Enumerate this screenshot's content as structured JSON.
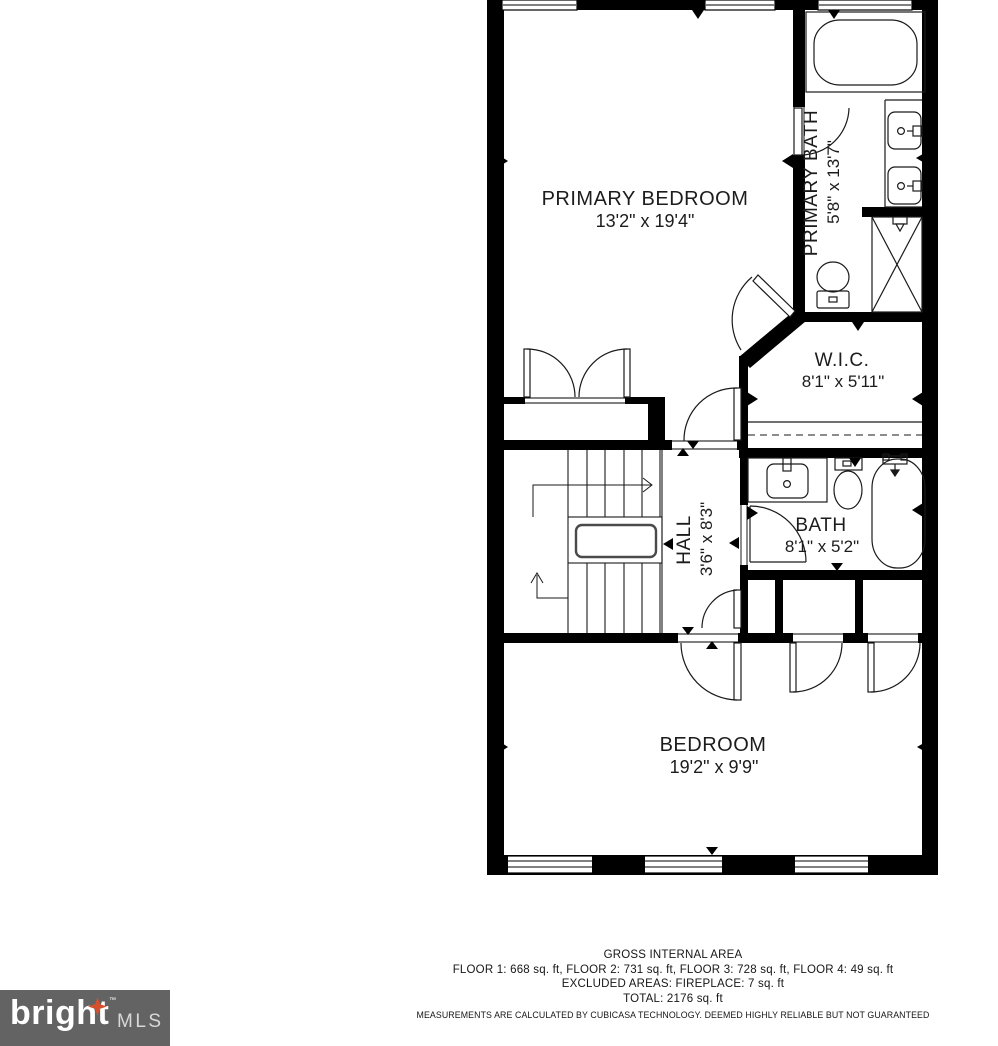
{
  "rooms": {
    "primary_bedroom": {
      "name": "PRIMARY BEDROOM",
      "dims": "13'2\" x 19'4\""
    },
    "primary_bath": {
      "name": "PRIMARY BATH",
      "dims": "5'8\" x 13'7\""
    },
    "wic": {
      "name": "W.I.C.",
      "dims": "8'1\" x 5'11\""
    },
    "hall": {
      "name": "HALL",
      "dims": "3'6\" x 8'3\""
    },
    "bath": {
      "name": "BATH",
      "dims": "8'1\" x 5'2\""
    },
    "bedroom": {
      "name": "BEDROOM",
      "dims": "19'2\" x 9'9\""
    }
  },
  "footer": {
    "title": "GROSS INTERNAL AREA",
    "floors": "FLOOR 1: 668 sq. ft, FLOOR 2: 731 sq. ft, FLOOR 3: 728 sq. ft, FLOOR 4: 49 sq. ft",
    "excluded": "EXCLUDED AREAS: FIREPLACE: 7 sq. ft",
    "total": "TOTAL: 2176 sq. ft",
    "disclaimer": "MEASUREMENTS ARE CALCULATED BY CUBICASA TECHNOLOGY. DEEMED HIGHLY RELIABLE BUT NOT GUARANTEED"
  },
  "logo": {
    "brand": "bright",
    "suffix": "MLS",
    "tm": "™"
  },
  "colors": {
    "wall": "#000000",
    "logo_bg": "#636363",
    "logo_star": "#d5502d",
    "logo_mls": "#d8d8d8"
  }
}
